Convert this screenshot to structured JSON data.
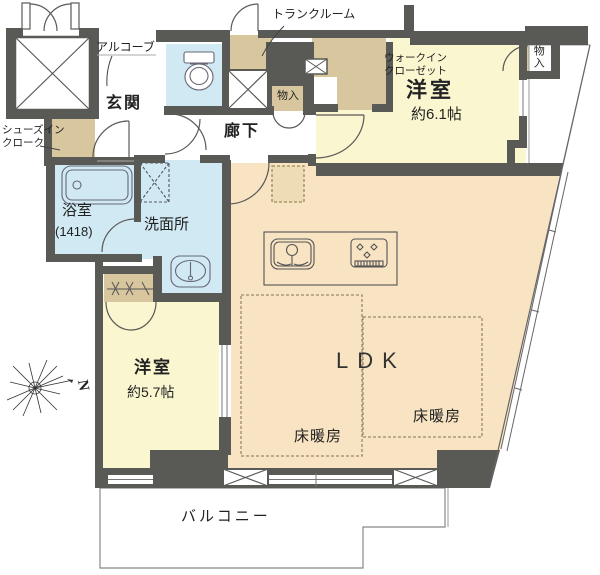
{
  "title": "マンション間取り図",
  "rooms": {
    "alcove": {
      "label": "アルコーブ"
    },
    "trunk_room": {
      "label": "トランクルーム"
    },
    "entrance": {
      "label": "玄関"
    },
    "corridor": {
      "label": "廊下"
    },
    "storage_hall": {
      "label": "物入"
    },
    "walk_in_closet": {
      "label": "ウォークイン\nクローゼット"
    },
    "bedroom_61": {
      "label": "洋室",
      "size": "約6.1帖"
    },
    "storage_bedroom": {
      "label": "物入"
    },
    "shoes_in_cloak": {
      "label": "シューズイン\nクローク"
    },
    "bathroom": {
      "label": "浴室",
      "size": "(1418)"
    },
    "washroom": {
      "label": "洗面所"
    },
    "ldk": {
      "label": "LDK"
    },
    "floor_heating_1": {
      "label": "床暖房"
    },
    "floor_heating_2": {
      "label": "床暖房"
    },
    "bedroom_57": {
      "label": "洋室",
      "size": "約5.7帖"
    },
    "balcony": {
      "label": "バルコニー"
    }
  },
  "compass": {
    "label": "N"
  },
  "fixtures": [
    "elevator-shaft",
    "toilet",
    "bathtub",
    "vanity-sink",
    "washing-machine-space",
    "kitchen-sink",
    "gas-stove",
    "refrigerator-space",
    "hanger-rod",
    "pipe-space"
  ],
  "colors": {
    "wall": "#595956",
    "room_yellow": "#FAF6D0",
    "room_peach": "#F8E3C2",
    "closet_tan": "#D8C69E",
    "water_blue": "#D0E9F3",
    "text": "#222222"
  }
}
